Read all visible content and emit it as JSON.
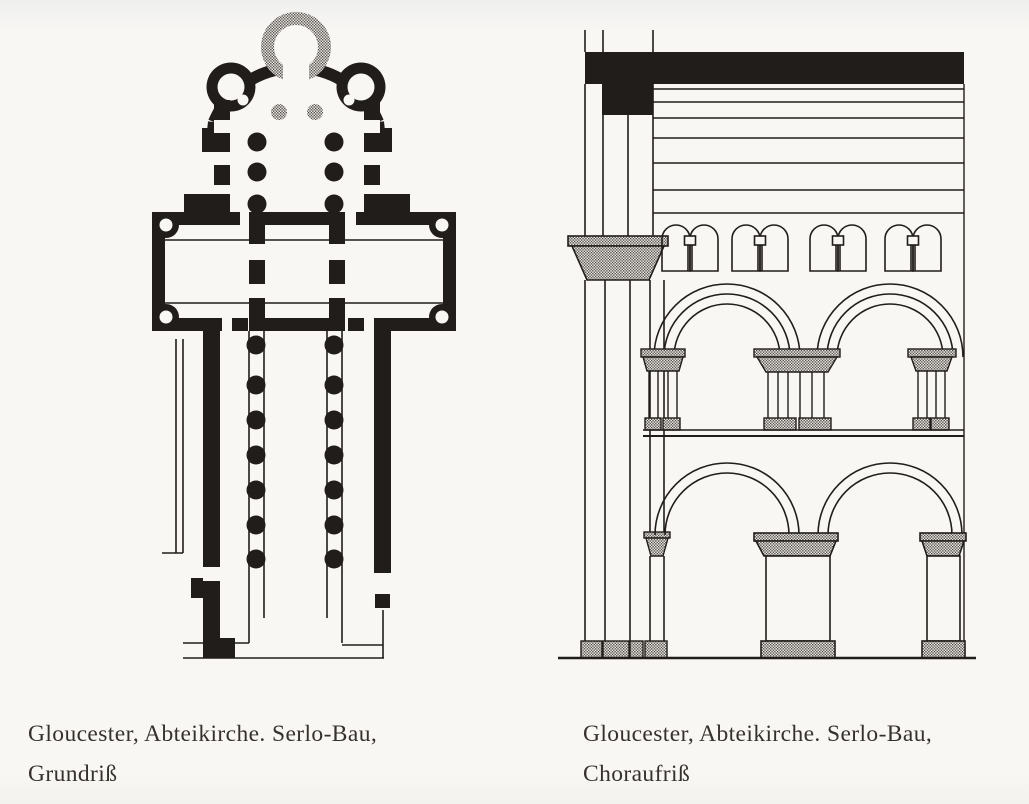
{
  "page": {
    "kind": "scanned book page with two architectural drawings",
    "paper_color": "#f8f7f4",
    "ink_color": "#211d1a",
    "stipple_color": "#6f6b66",
    "caption_color": "#36312c"
  },
  "figures": [
    {
      "id": "grundriss",
      "kind": "floor-plan",
      "caption_line1": "Gloucester, Abteikirche. Serlo-Bau,",
      "caption_line2": "Grundriß"
    },
    {
      "id": "choraufriss",
      "kind": "choir-elevation",
      "caption_line1": "Gloucester, Abteikirche. Serlo-Bau,",
      "caption_line2": "Choraufriß"
    }
  ]
}
